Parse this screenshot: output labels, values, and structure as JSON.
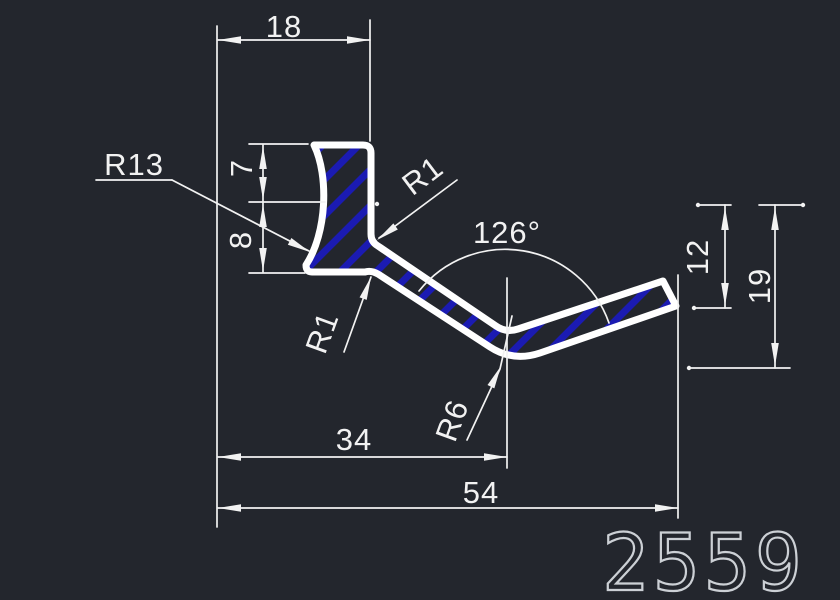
{
  "drawing": {
    "type": "CAD profile cross-section drawing",
    "part_number": "2559",
    "dimensions": {
      "top_width": "18",
      "head_upper_height": "7",
      "head_lower_height": "8",
      "left_concave_radius": "R13",
      "inner_radius_upper": "R1",
      "inner_radius_lower": "R1",
      "bend_angle": "126°",
      "right_height_inner": "12",
      "right_height_outer": "19",
      "width_to_vertex": "34",
      "overall_width": "54",
      "vertex_radius": "R6"
    }
  },
  "colors": {
    "background": "#23262d",
    "line": "#f2f2f2",
    "outline": "#ffffff",
    "hatch": "#1b1bb2",
    "part_number": "#ccd0d5"
  }
}
